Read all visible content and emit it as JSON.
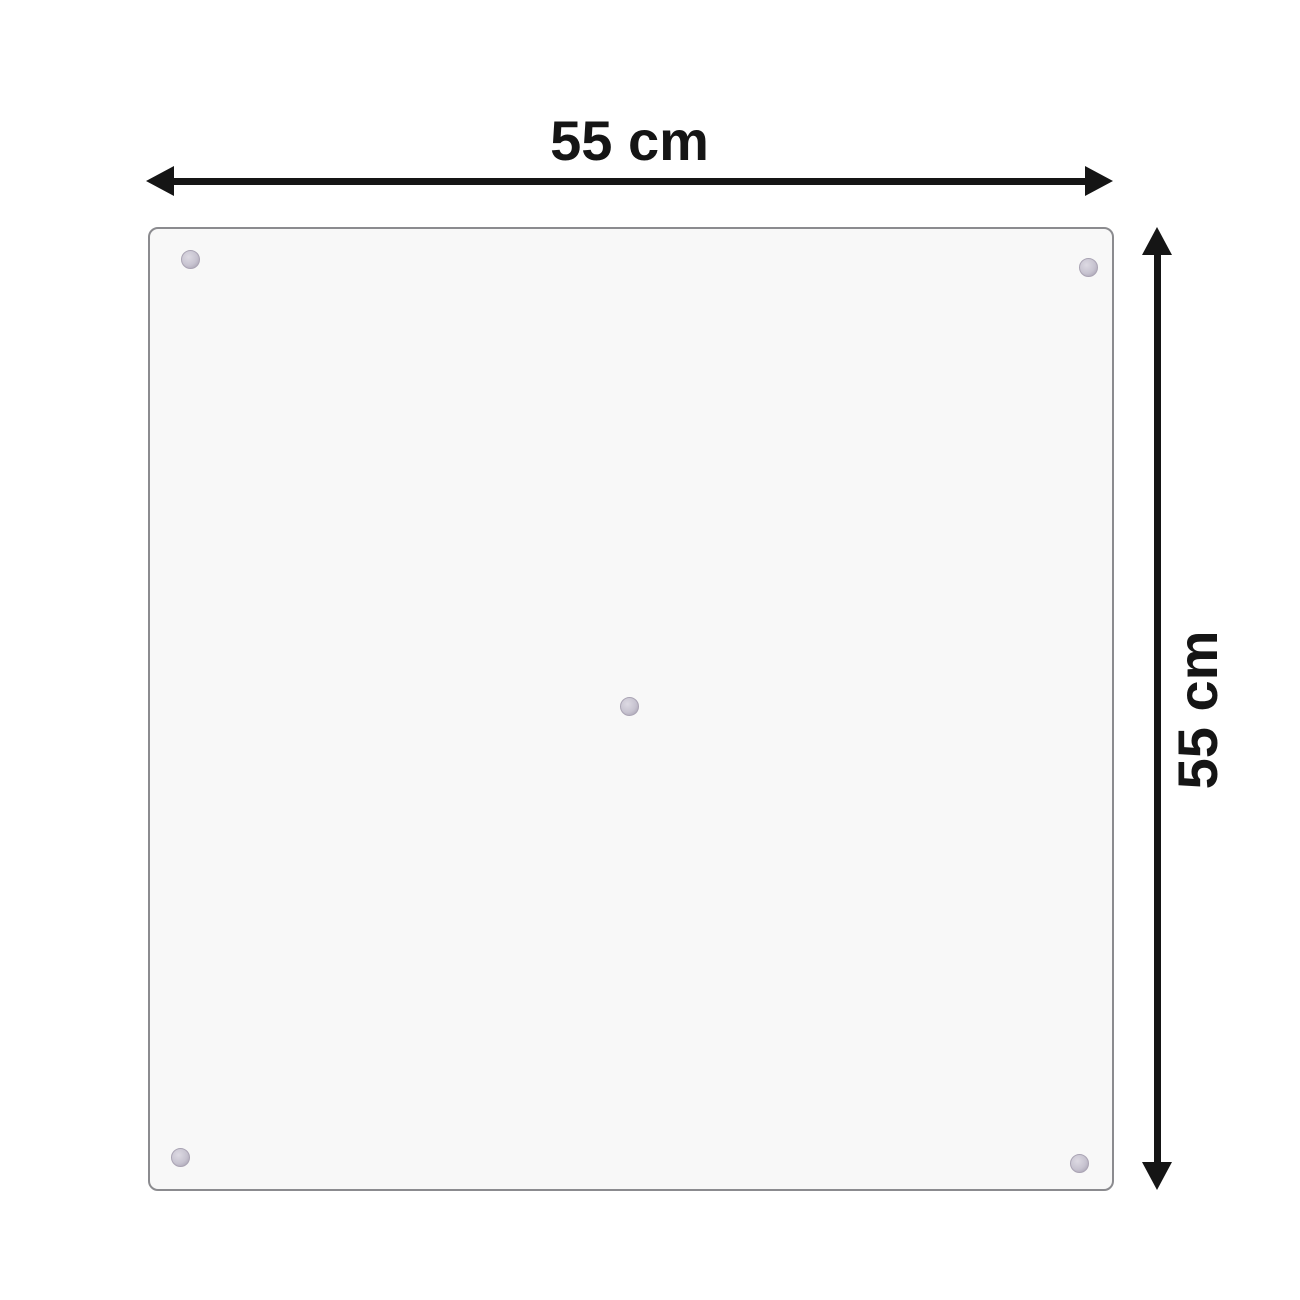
{
  "diagram": {
    "type": "product-dimension-diagram",
    "width_label": "55 cm",
    "height_label": "55 cm",
    "panel": {
      "shape": "square",
      "mount_point_positions": [
        "top-left",
        "top-right",
        "center",
        "bottom-left",
        "bottom-right"
      ],
      "mount_point_count": 5
    },
    "icons": {
      "width_arrow": "double-headed-arrow-horizontal",
      "height_arrow": "double-headed-arrow-vertical",
      "mount_point": "suction-cup-dot"
    },
    "colors": {
      "background": "#ffffff",
      "arrow": "#151515",
      "label_text": "#151515",
      "panel_fill": "#f8f8f8",
      "panel_border": "#8b8b8f",
      "suction_cup_fill": "#c7c3d0",
      "suction_cup_rim": "#aaa4b4",
      "suction_cup_highlight": "#dddae3"
    }
  }
}
